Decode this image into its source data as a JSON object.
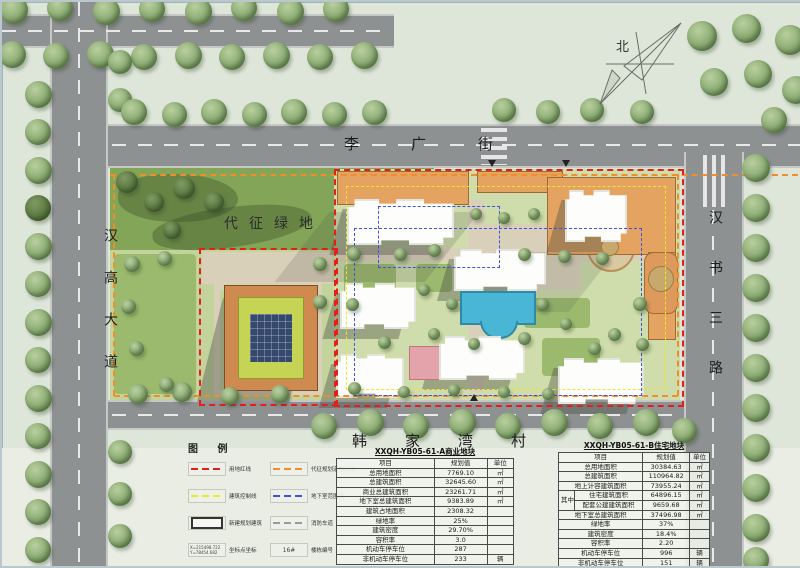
{
  "plan": {
    "north_label": "北",
    "streets": {
      "top": "李广街",
      "left": "汉高大道",
      "right": "汉书三路"
    },
    "village": "韩家湾村",
    "green_area": "代征绿地"
  },
  "legend": {
    "title": "图 例",
    "columns": [
      [
        {
          "swatch": "dash",
          "color": "#e32017",
          "label": "用地红线"
        },
        {
          "swatch": "dash",
          "color": "#f0e62c",
          "label": "建筑控制线"
        },
        {
          "swatch": "rect",
          "color": "#333333",
          "label": "新建规划建筑"
        },
        {
          "swatch": "coord",
          "color": "#444444",
          "label": "坐标点坐标",
          "sample": [
            "X=215498.722",
            "Y=78454.682"
          ]
        }
      ],
      [
        {
          "swatch": "dash",
          "color": "#ef8e2a",
          "label": "代征规划道路红线"
        },
        {
          "swatch": "dash",
          "color": "#3f51e0",
          "label": "地下室范围线"
        },
        {
          "swatch": "dash",
          "color": "#9a9a9a",
          "label": "消防车道"
        },
        {
          "swatch": "tag",
          "color": "#444444",
          "label": "楼栋编号",
          "sample": "16#"
        }
      ]
    ]
  },
  "tables": [
    {
      "title": "XXQH-YB05-61-A商业地块",
      "headers": [
        "项目",
        "规划值",
        "单位"
      ],
      "rows": [
        [
          "总用地面积",
          "7769.10",
          "㎡",
          ""
        ],
        [
          "总建筑面积",
          "32645.60",
          "㎡",
          ""
        ],
        [
          "商业总建筑面积",
          "23261.71",
          "㎡",
          ""
        ],
        [
          "地下室总建筑面积",
          "9383.89",
          "㎡",
          ""
        ],
        [
          "建筑占地面积",
          "2308.32",
          "",
          ""
        ],
        [
          "绿地率",
          "25%",
          "",
          ""
        ],
        [
          "建筑密度",
          "29.70%",
          "",
          ""
        ],
        [
          "容积率",
          "3.0",
          "",
          ""
        ],
        [
          "机动车停车位",
          "287",
          "",
          ""
        ],
        [
          "非机动车停车位",
          "233",
          "辆",
          ""
        ]
      ]
    },
    {
      "title": "XXQH-YB05-61-B住宅地块",
      "headers": [
        "项目",
        "规划值",
        "单位"
      ],
      "rows": [
        [
          "总用地面积",
          "30384.63",
          "㎡",
          ""
        ],
        [
          "总建筑面积",
          "110964.82",
          "㎡",
          ""
        ],
        [
          "地上计容建筑面积",
          "73955.24",
          "㎡",
          ""
        ],
        [
          "住宅建筑面积",
          "64896.15",
          "㎡",
          "其中"
        ],
        [
          "配套公建建筑面积",
          "9659.68",
          "㎡",
          "其中"
        ],
        [
          "地下室总建筑面积",
          "37496.98",
          "㎡",
          ""
        ],
        [
          "绿地率",
          "37%",
          "",
          ""
        ],
        [
          "建筑密度",
          "18.4%",
          "",
          ""
        ],
        [
          "容积率",
          "2.20",
          "",
          ""
        ],
        [
          "机动车停车位",
          "996",
          "辆",
          ""
        ],
        [
          "非机动车停车位",
          "151",
          "辆",
          ""
        ]
      ]
    }
  ]
}
